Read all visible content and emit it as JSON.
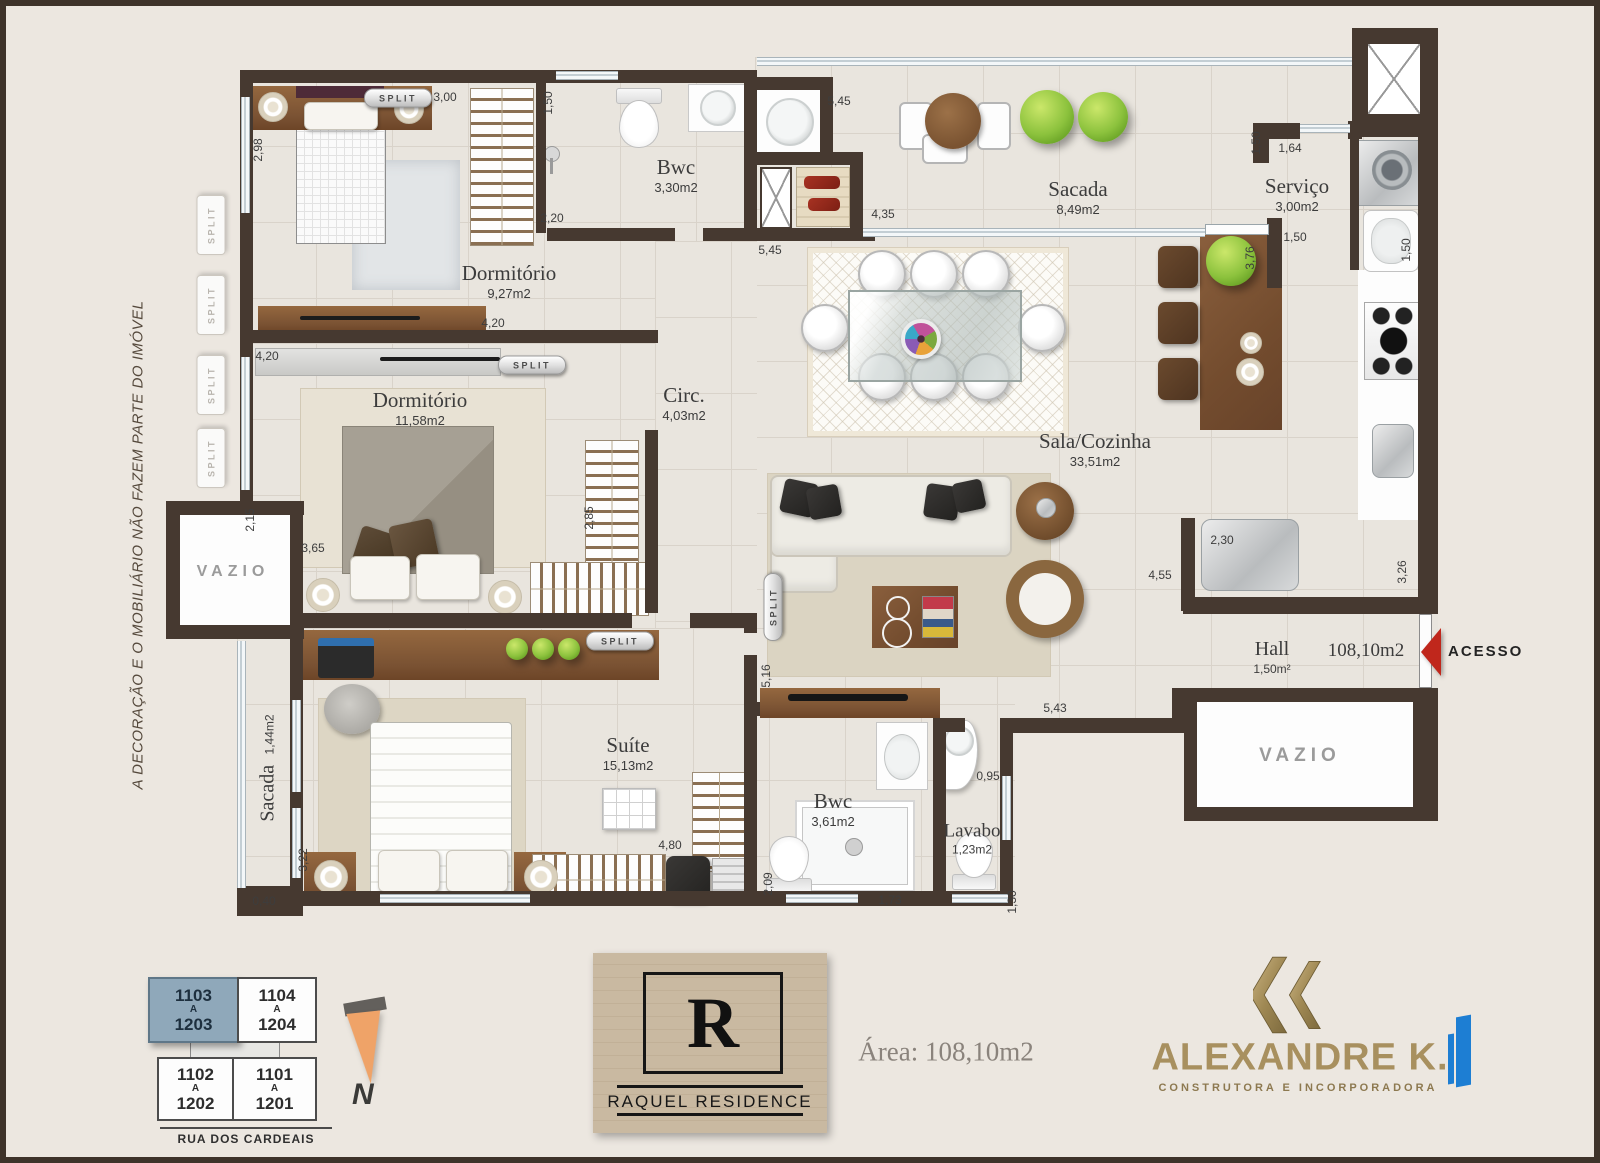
{
  "labels": {
    "disclaimer": "A  DECORAÇÃO E O MOBILIÁRIO NÃO FAZEM PARTE DO IMÓVEL",
    "acesso": "ACESSO",
    "north": "N",
    "total_area": "108,10m2"
  },
  "rooms": {
    "dorm1": {
      "name": "Dormitório",
      "area": "9,27m2"
    },
    "bwc1": {
      "name": "Bwc",
      "area": "3,30m2"
    },
    "sacada1": {
      "name": "Sacada",
      "area": "8,49m2"
    },
    "servico": {
      "name": "Serviço",
      "area": "3,00m2"
    },
    "circ": {
      "name": "Circ.",
      "area": "4,03m2"
    },
    "dorm2": {
      "name": "Dormitório",
      "area": "11,58m2"
    },
    "sala": {
      "name": "Sala/Cozinha",
      "area": "33,51m2"
    },
    "hall": {
      "name": "Hall",
      "area": "1,50m²"
    },
    "suite": {
      "name": "Suíte",
      "area": "15,13m2"
    },
    "bwc2": {
      "name": "Bwc",
      "area": "3,61m2"
    },
    "lavabo": {
      "name": "Lavabo",
      "area": "1,23m2"
    },
    "sacada2": {
      "name": "Sacada",
      "area": "1,44m2"
    },
    "vazio1": {
      "name": "VAZIO"
    },
    "vazio2": {
      "name": "VAZIO"
    }
  },
  "split_label": "SPLIT",
  "splits": [
    {
      "x": 398,
      "y": 98,
      "o": "h"
    },
    {
      "x": 532,
      "y": 365,
      "o": "h"
    },
    {
      "x": 620,
      "y": 641,
      "o": "h"
    },
    {
      "x": 773,
      "y": 607,
      "o": "v"
    },
    {
      "x": 211,
      "y": 225,
      "o": "g"
    },
    {
      "x": 211,
      "y": 305,
      "o": "g"
    },
    {
      "x": 211,
      "y": 385,
      "o": "g"
    },
    {
      "x": 211,
      "y": 458,
      "o": "g"
    }
  ],
  "dimensions": [
    {
      "t": "3,00",
      "x": 445,
      "y": 97,
      "v": false
    },
    {
      "t": "2,98",
      "x": 258,
      "y": 150,
      "v": true
    },
    {
      "t": "1,50",
      "x": 548,
      "y": 103,
      "v": true
    },
    {
      "t": "2,20",
      "x": 552,
      "y": 218,
      "v": false
    },
    {
      "t": "4,20",
      "x": 493,
      "y": 323,
      "v": false
    },
    {
      "t": "4,20",
      "x": 267,
      "y": 356,
      "v": false
    },
    {
      "t": "5,45",
      "x": 839,
      "y": 101,
      "v": false
    },
    {
      "t": "4,35",
      "x": 883,
      "y": 214,
      "v": false
    },
    {
      "t": "5,45",
      "x": 770,
      "y": 250,
      "v": false
    },
    {
      "t": "1,50",
      "x": 1256,
      "y": 143,
      "v": true
    },
    {
      "t": "1,64",
      "x": 1290,
      "y": 148,
      "v": false
    },
    {
      "t": "1,50",
      "x": 1295,
      "y": 237,
      "v": false
    },
    {
      "t": "3,76",
      "x": 1250,
      "y": 258,
      "v": true
    },
    {
      "t": "1,50",
      "x": 1406,
      "y": 250,
      "v": true
    },
    {
      "t": "2,15",
      "x": 250,
      "y": 520,
      "v": true
    },
    {
      "t": "3,65",
      "x": 313,
      "y": 548,
      "v": false
    },
    {
      "t": "2,85",
      "x": 589,
      "y": 518,
      "v": true
    },
    {
      "t": "5,16",
      "x": 766,
      "y": 676,
      "v": true
    },
    {
      "t": "5,43",
      "x": 1055,
      "y": 708,
      "v": false
    },
    {
      "t": "4,55",
      "x": 1160,
      "y": 575,
      "v": false
    },
    {
      "t": "2,30",
      "x": 1222,
      "y": 540,
      "v": false
    },
    {
      "t": "3,26",
      "x": 1402,
      "y": 572,
      "v": true
    },
    {
      "t": "4,80",
      "x": 670,
      "y": 845,
      "v": false
    },
    {
      "t": "3,22",
      "x": 303,
      "y": 860,
      "v": true
    },
    {
      "t": "0,40",
      "x": 264,
      "y": 901,
      "v": false
    },
    {
      "t": "2,09",
      "x": 768,
      "y": 884,
      "v": true
    },
    {
      "t": "1,73",
      "x": 890,
      "y": 900,
      "v": false
    },
    {
      "t": "0,95",
      "x": 988,
      "y": 776,
      "v": false
    },
    {
      "t": "1,30",
      "x": 1012,
      "y": 902,
      "v": true
    }
  ],
  "keyplan": {
    "street": "RUA  DOS  CARDEAIS",
    "units": [
      {
        "top": "1103",
        "mid": "A",
        "bottom": "1203",
        "highlight": true
      },
      {
        "top": "1104",
        "mid": "A",
        "bottom": "1204",
        "highlight": false
      },
      {
        "top": "1102",
        "mid": "A",
        "bottom": "1202",
        "highlight": false
      },
      {
        "top": "1101",
        "mid": "A",
        "bottom": "1201",
        "highlight": false
      }
    ]
  },
  "branding": {
    "raquel_initial": "R",
    "raquel_name": "RAQUEL RESIDENCE",
    "area_text": "Área: 108,10m2",
    "builder_name": "ALEXANDRE K.",
    "builder_sub": "CONSTRUTORA E INCORPORADORA"
  },
  "colors": {
    "wall": "#463930",
    "accent_red": "#c0271c",
    "gold": "#a8905f",
    "blue": "#1d7ed3",
    "keyplan_highlight": "#8fa8ba",
    "north_orange": "#efa368"
  }
}
